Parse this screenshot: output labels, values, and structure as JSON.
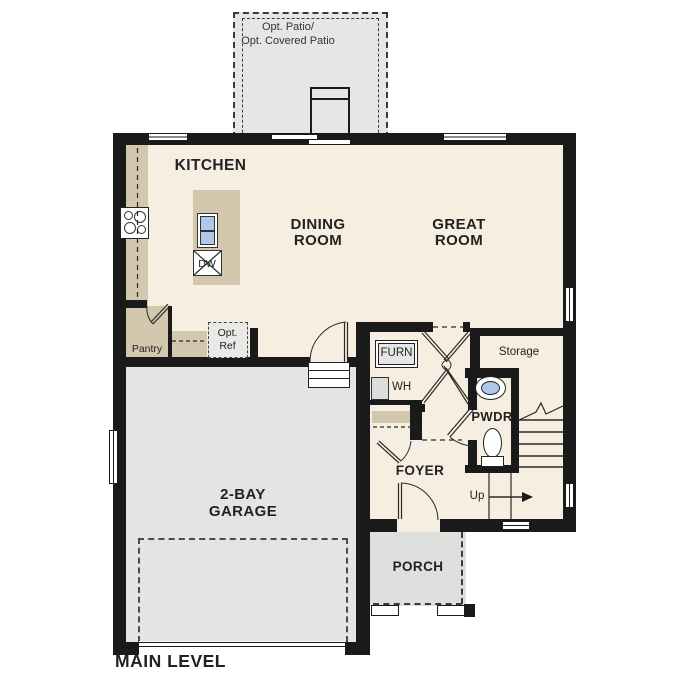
{
  "plan_title": "MAIN LEVEL",
  "rooms": {
    "kitchen": "KITCHEN",
    "dining_room": "DINING ROOM",
    "great_room": "GREAT ROOM",
    "garage": "2-BAY GARAGE",
    "foyer": "FOYER",
    "porch": "PORCH",
    "powder_room": "PWDR",
    "storage": "Storage",
    "pantry": "Pantry",
    "patio": {
      "line1": "Opt. Patio/",
      "line2": "Opt. Covered Patio"
    }
  },
  "fixtures": {
    "furnace": "FURN",
    "water_heater": "WH",
    "dishwasher": "DW",
    "optional_refrigerator": "Opt. Ref",
    "stairs_direction": "Up"
  },
  "colors": {
    "wall": "#1a1a1a",
    "floor": "#f6eee0",
    "cabinetry": "#d3c7ad",
    "concrete": "#e4e4e2",
    "sink_water": "#aec9e8"
  }
}
